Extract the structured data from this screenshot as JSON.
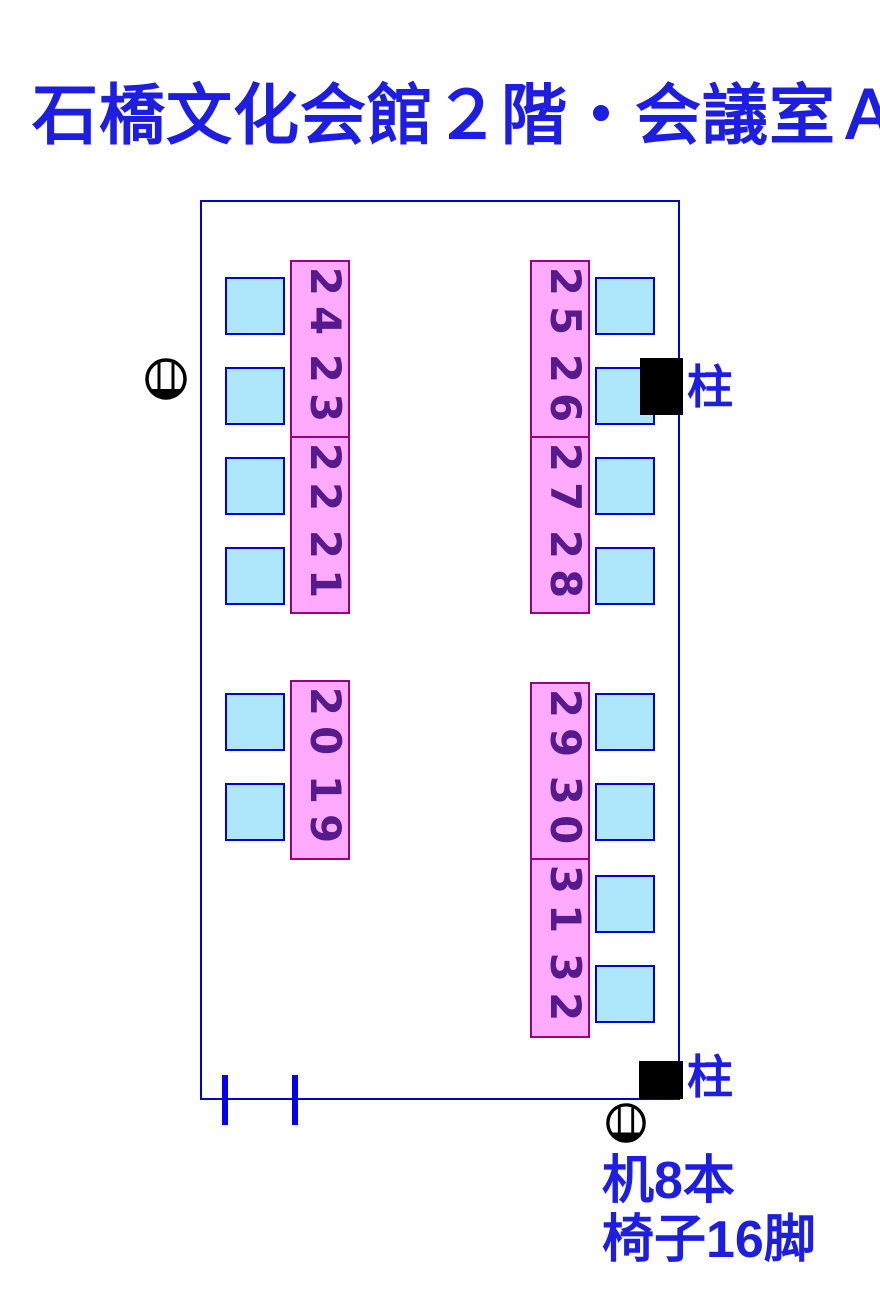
{
  "title": "石橋文化会館２階・会議室Ａ",
  "colors": {
    "accent_blue": "#1e1ee0",
    "room_border": "#0000cd",
    "table_fill": "#ffaafc",
    "table_border": "#990080",
    "digit_purple": "#551b8c",
    "chair_fill": "#aee7fb",
    "chair_border": "#0000dd",
    "tick_blue": "#0000ee",
    "pillar_black": "#000000"
  },
  "room": {
    "pillars": [
      {
        "label": "柱"
      },
      {
        "label": "柱"
      }
    ],
    "door_symbols": [
      {
        "name": "door-knob-symbol-left"
      },
      {
        "name": "door-knob-symbol-bottom"
      }
    ],
    "notes": [
      {
        "text": "机8本"
      },
      {
        "text": "椅子16脚"
      }
    ]
  },
  "groups": [
    {
      "name": "top-left",
      "chair_side": "left",
      "tables": [
        {
          "first": "24",
          "second": "23"
        },
        {
          "first": "22",
          "second": "21"
        }
      ]
    },
    {
      "name": "top-right",
      "chair_side": "right",
      "tables": [
        {
          "first": "25",
          "second": "26"
        },
        {
          "first": "27",
          "second": "28"
        }
      ]
    },
    {
      "name": "bottom-left",
      "chair_side": "left",
      "tables": [
        {
          "first": "20",
          "second": "19"
        }
      ]
    },
    {
      "name": "bottom-right",
      "chair_side": "right",
      "tables": [
        {
          "first": "29",
          "second": "30"
        },
        {
          "first": "31",
          "second": "32"
        }
      ]
    }
  ]
}
